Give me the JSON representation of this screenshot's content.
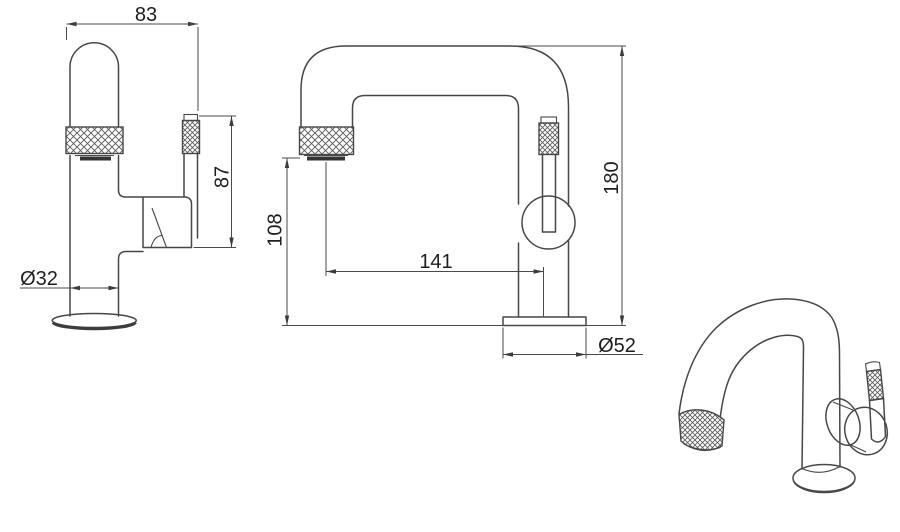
{
  "drawing": {
    "type": "faucet technical drawing, three views",
    "background": "#ffffff",
    "line_color": "#474747",
    "dimension_color": "#4a4a4a",
    "text_color": "#1e1e1e",
    "dims": {
      "spout_width": "83",
      "handle_height": "87",
      "body_diameter": "Ø32",
      "outlet_height": "108",
      "spout_reach": "141",
      "total_height": "180",
      "base_diameter": "Ø52"
    }
  }
}
